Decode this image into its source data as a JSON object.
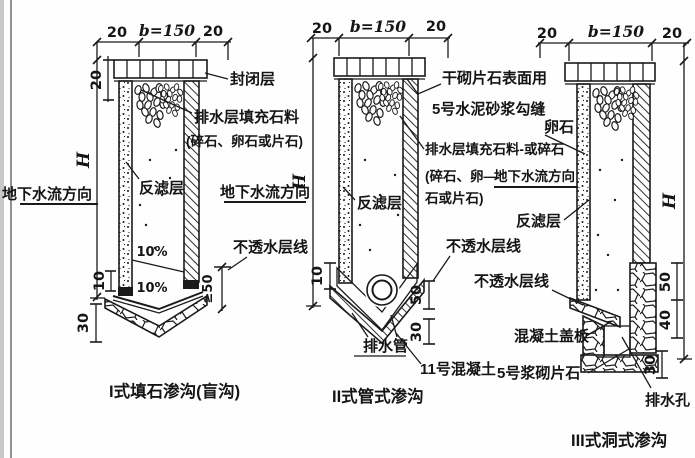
{
  "d1": {
    "caption": "I式填石渗沟(盲沟)",
    "dim_left": "20",
    "dim_width": "b=150",
    "dim_right": "20",
    "dim_cap": "20",
    "dim_height": "H",
    "dim_footing": "10",
    "dim_base": "30",
    "dim_embed": "≥50",
    "slope_upper": "10%",
    "slope_lower": "10%",
    "label_sealing": "封闭层",
    "label_fill_1": "排水层填充石料",
    "label_fill_2": "(碎石、卵石或片石)",
    "label_filter": "反滤层",
    "label_flow": "地下水流方向",
    "label_impermeable": "不透水层线"
  },
  "d2": {
    "caption": "II式管式渗沟",
    "dim_left": "20",
    "dim_width": "b=150",
    "dim_right": "20",
    "dim_height": "H",
    "dim_footing": "10",
    "dim_depth": "50",
    "dim_base": "30",
    "label_cap_1": "干砌片石表面用",
    "label_cap_2": "5号水泥砂浆勾缝",
    "label_fill_1": "排水层填充石料-或碎石",
    "label_fill_2": "(碎石、卵—",
    "label_fill_3": "石或片石)",
    "label_filter": "反滤层",
    "label_flow": "地下水流方向",
    "label_impermeable": "不透水层线",
    "label_pipe": "排水管",
    "label_concrete": "11号混凝土"
  },
  "d3": {
    "caption": "III式洞式渗沟",
    "dim_left": "20",
    "dim_width": "b=150",
    "dim_right": "20",
    "dim_height": "H",
    "dim_upper": "50",
    "dim_middle": "40",
    "dim_lower": "30",
    "label_cobble": "卵石",
    "label_flow": "地下水流方向",
    "label_filter": "反滤层",
    "label_impermeable": "不透水层线",
    "label_cover": "混凝土盖板",
    "label_masonry": "5号浆砌片石",
    "label_drain_hole": "排水孔"
  }
}
